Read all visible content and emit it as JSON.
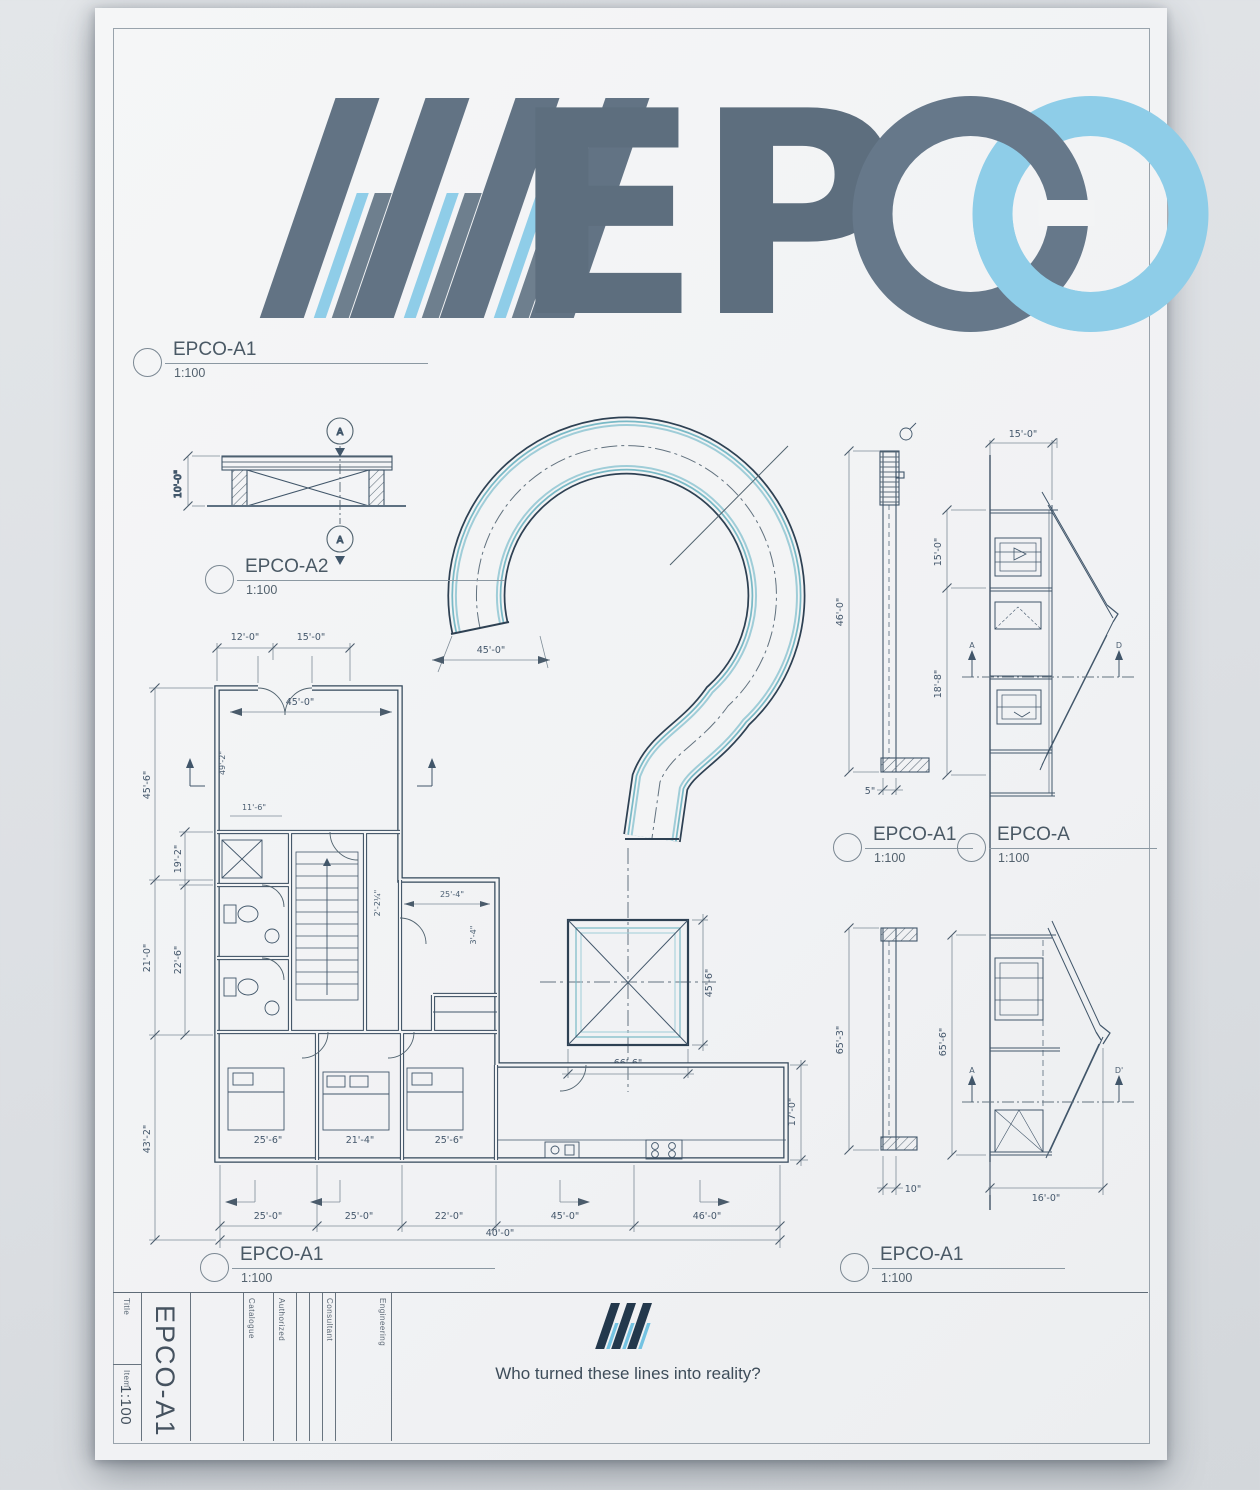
{
  "page": {
    "logo_text": "EP",
    "tagline": "Who turned these lines into reality?"
  },
  "colors": {
    "logo_gray": "#62748466",
    "logo_blue": "#8ecde8",
    "ink_dark": "#33475a",
    "teal": "#79b9c6"
  },
  "markers": {
    "m1": {
      "title": "EPCO-A1",
      "scale": "1:100"
    },
    "m2": {
      "title": "EPCO-A2",
      "scale": "1:100"
    },
    "m3": {
      "title": "EPCO-A1",
      "scale": "1:100"
    },
    "m4": {
      "title": "EPCO-A",
      "scale": "1:100"
    },
    "m5": {
      "title": "EPCO-A1",
      "scale": "1:100"
    },
    "m6": {
      "title": "EPCO-A1",
      "scale": "1:100"
    }
  },
  "section_a": {
    "dim": "10'-0\"",
    "marker": "A"
  },
  "qmark": {
    "dim_left": "45'-0\"",
    "dim_square_h": "45'-6\"",
    "dim_square_w": "66'-6\""
  },
  "plan": {
    "top": [
      "12'-0\"",
      "15'-0\""
    ],
    "entry": "45'-0\"",
    "left_outer": [
      "45'-6\"",
      "21'-0\"",
      "43'-2\""
    ],
    "left_inner": [
      "19'-2\"",
      "22'-6\""
    ],
    "interior": [
      "49'-2\"",
      "11'-6\"",
      "2'-2¼\"",
      "25'-4\"",
      "3'-4\""
    ],
    "rooms": [
      "25'-6\"",
      "21'-4\"",
      "25'-6\""
    ],
    "chain": [
      "25'-0\"",
      "25'-0\"",
      "22'-0\"",
      "45'-0\"",
      "46'-0\""
    ],
    "total": "40'-0\"",
    "right": "17'-0\""
  },
  "elev_top": {
    "wall_h": "46'-0\"",
    "wall_w": "5\"",
    "top": "15'-0\"",
    "left1": "15'-0\"",
    "left2": "18'-8\"",
    "mk_l": "A",
    "mk_r": "D"
  },
  "elev_bot": {
    "wall_h": "65'-3\"",
    "wall_w": "10\"",
    "left": "65'-6\"",
    "bottom": "16'-0\"",
    "mk_l": "A",
    "mk_r": "D'"
  },
  "titleblock": {
    "col1_top": "Title",
    "col1_mid": "Item",
    "scale": "1:100",
    "sheet": "EPCO-A1",
    "headers": [
      "Catalogue",
      "Authorized",
      "Consultant",
      "Engineering"
    ]
  }
}
